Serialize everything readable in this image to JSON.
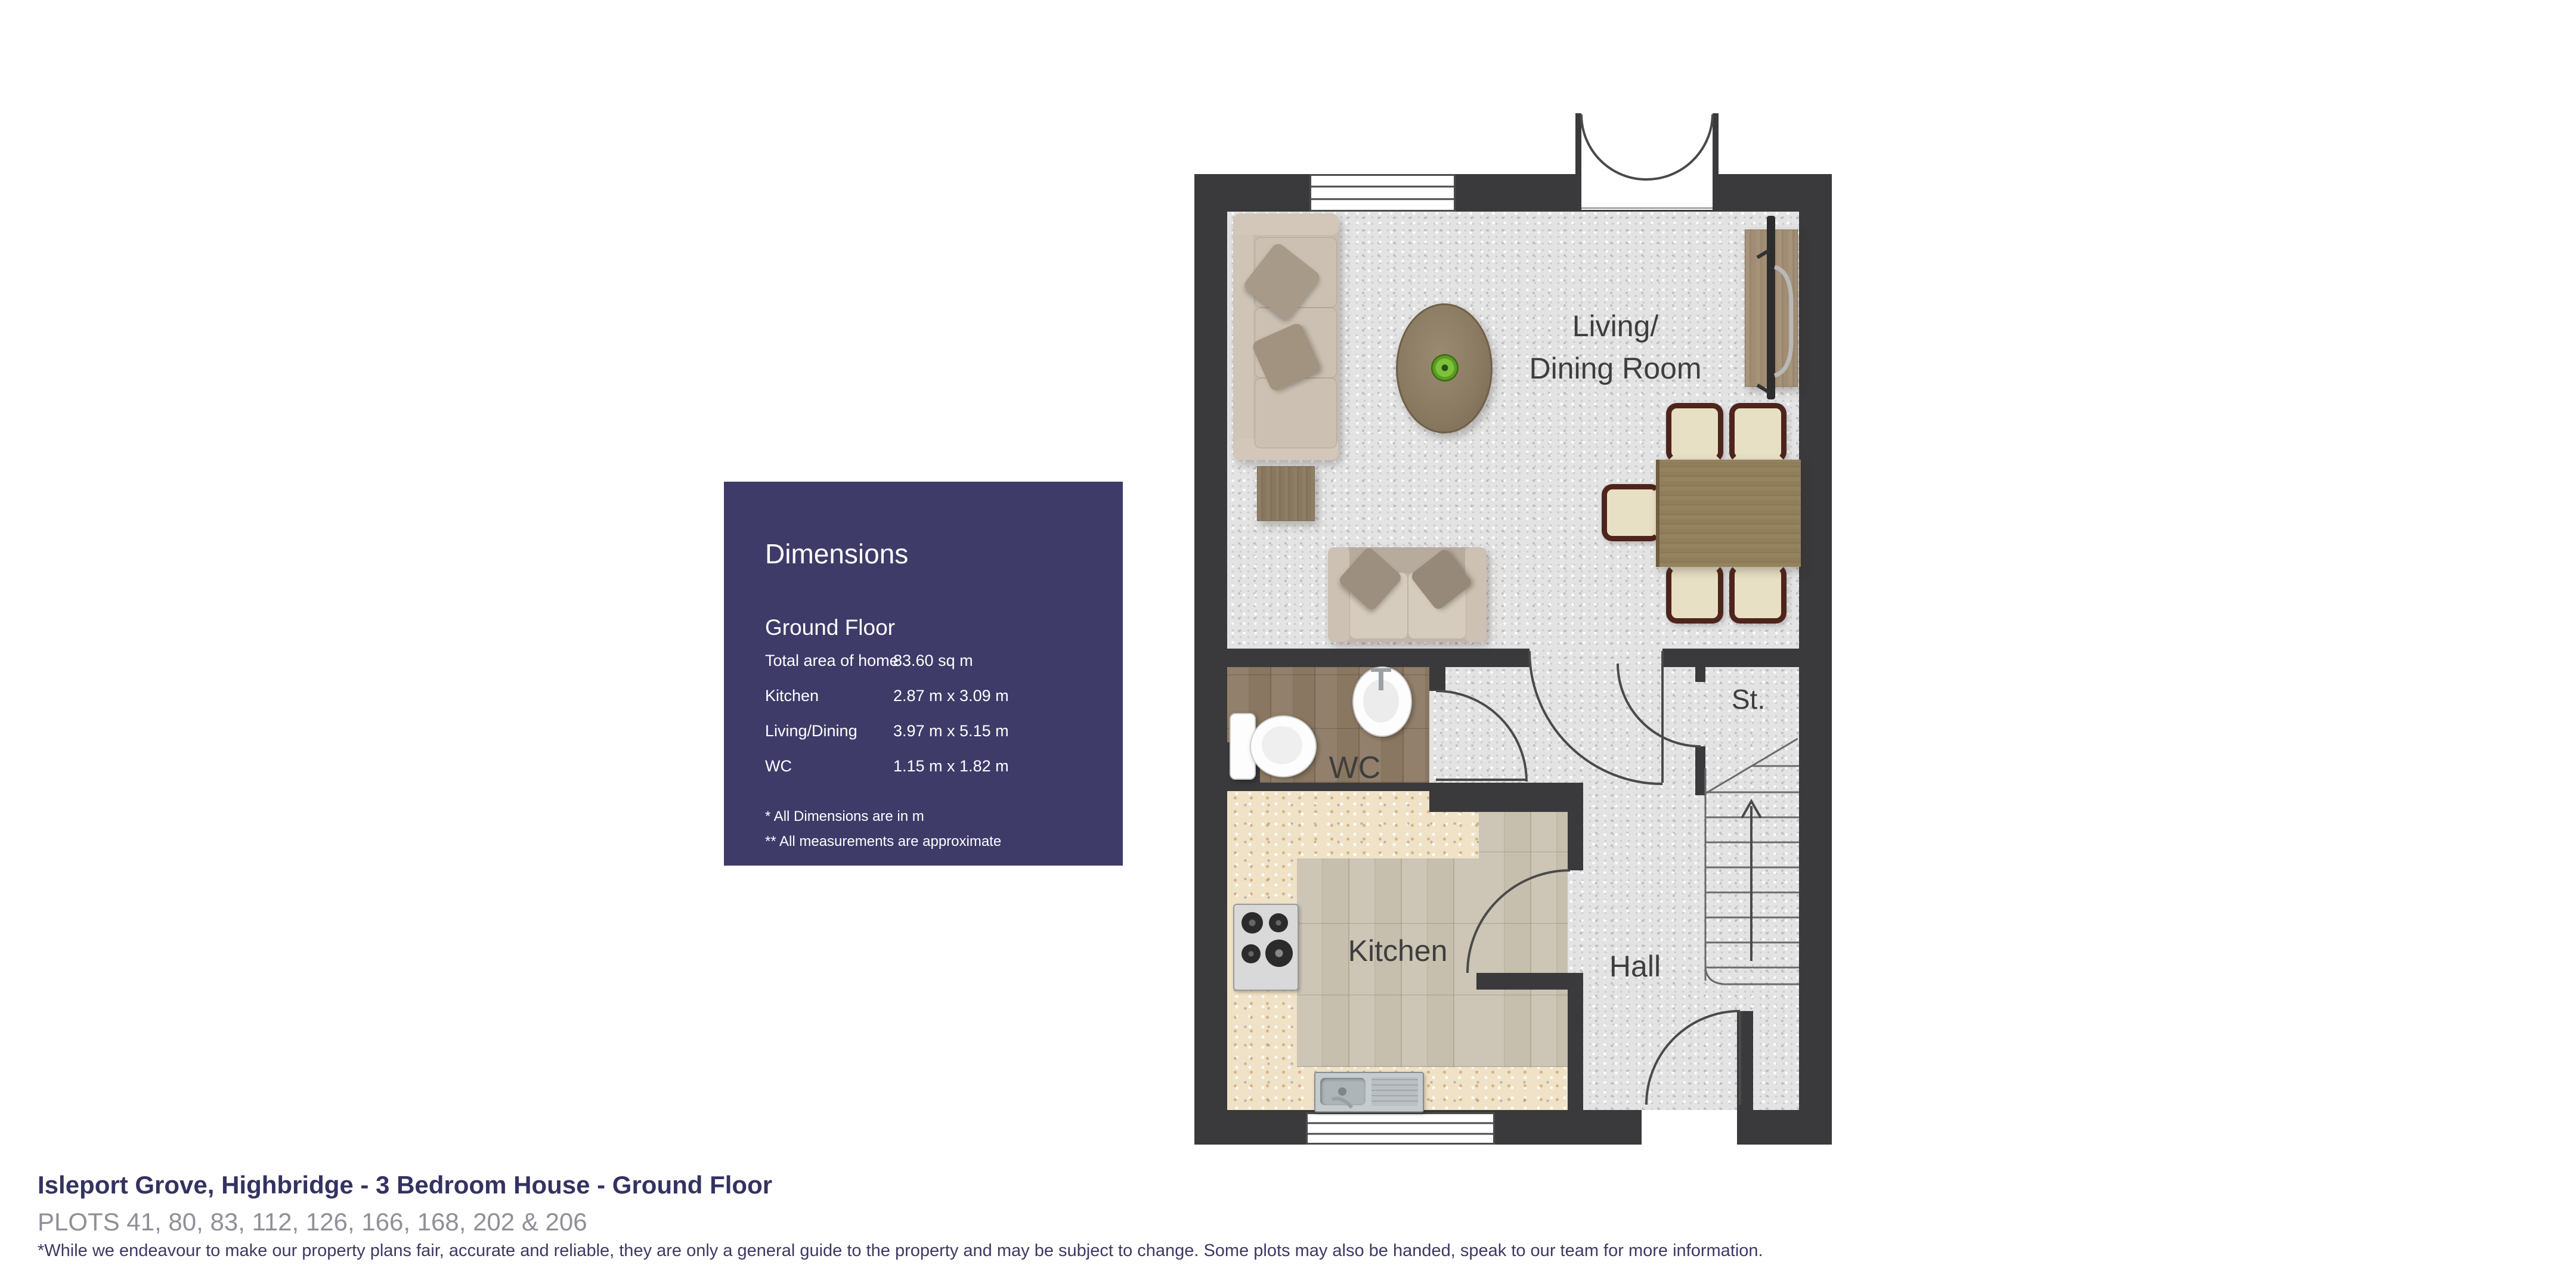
{
  "colors": {
    "wall": "#3a393b",
    "panel": "#3e3b69",
    "carpet": "#e3e3e3",
    "navy": "#333260",
    "gray": "#8f8f98",
    "disclaimernavy": "#3b3963",
    "label": "#3e3e3e"
  },
  "panel": {
    "title": "Dimensions",
    "section": "Ground Floor",
    "rows": [
      {
        "label": "Total area of home",
        "value": "83.60 sq m"
      },
      {
        "label": "Kitchen",
        "value": "2.87 m x 3.09 m"
      },
      {
        "label": "Living/Dining",
        "value": "3.97 m x 5.15 m"
      },
      {
        "label": "WC",
        "value": "1.15 m x 1.82 m"
      }
    ],
    "footnotes": [
      "* All Dimensions are in m",
      "** All measurements are approximate"
    ]
  },
  "rooms": {
    "living_line1": "Living/",
    "living_line2": "Dining Room",
    "kitchen": "Kitchen",
    "hall": "Hall",
    "wc": "WC",
    "storage": "St."
  },
  "footer": {
    "title": "Isleport Grove, Highbridge - 3 Bedroom House - Ground Floor",
    "plots": "PLOTS 41, 80, 83, 112, 126, 166, 168, 202 & 206",
    "disclaimer": "*While we endeavour to make our property plans fair, accurate and reliable, they are only a general guide to the property and may be subject to change. Some plots may also be handed, speak to our team for more information."
  }
}
